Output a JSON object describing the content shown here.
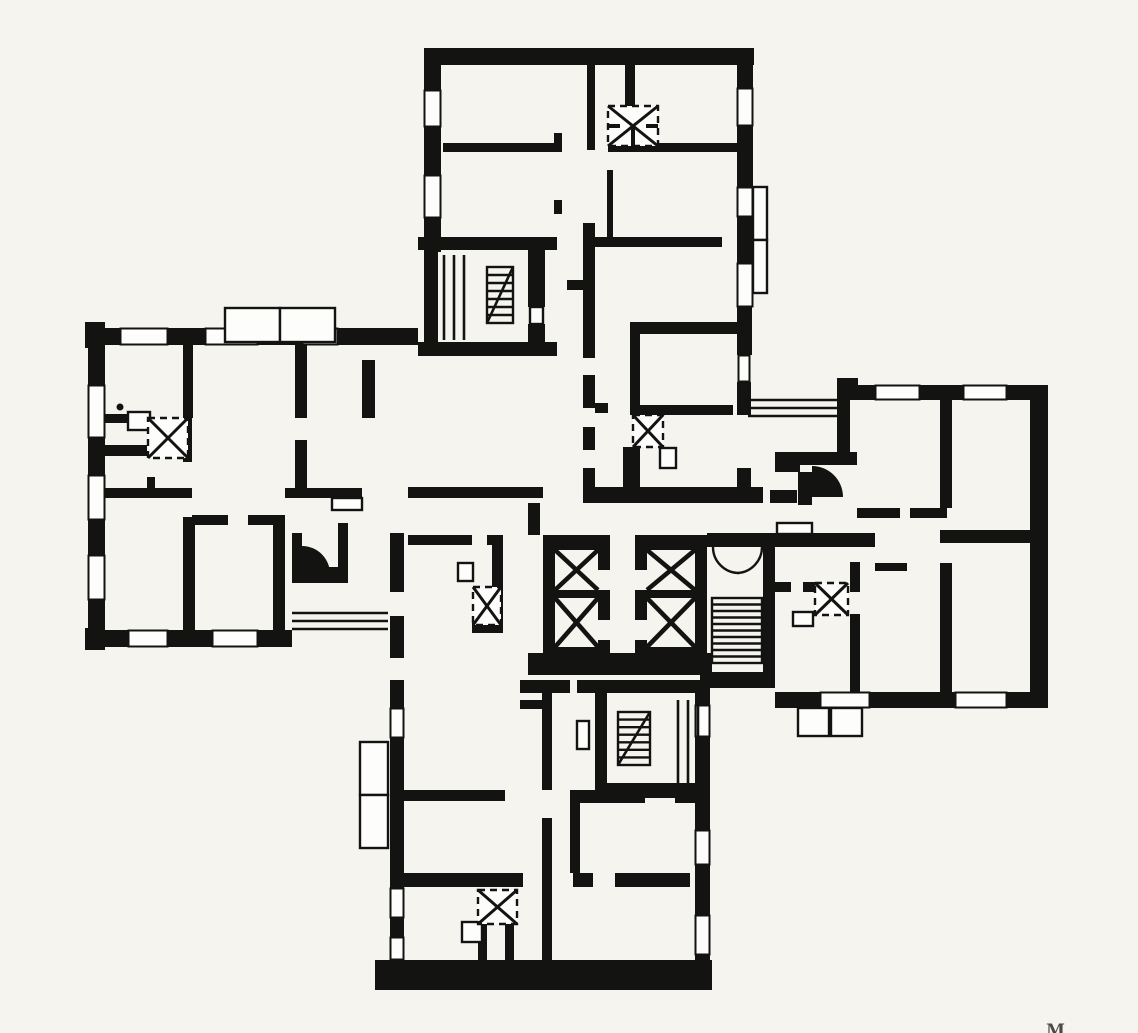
{
  "meta": {
    "kind": "architectural floor plan (scanned, cross-shaped apartment building)",
    "canvas": {
      "w": 1138,
      "h": 1033,
      "paper": "#f5f4ef",
      "ink": "#131312"
    },
    "mark": {
      "text": "M"
    }
  },
  "walls": [
    [
      424,
      48,
      330,
      17
    ],
    [
      424,
      48,
      17,
      42
    ],
    [
      424,
      127,
      17,
      48
    ],
    [
      424,
      218,
      17,
      34
    ],
    [
      737,
      48,
      16,
      40
    ],
    [
      737,
      126,
      16,
      61
    ],
    [
      737,
      217,
      16,
      46
    ],
    [
      737,
      307,
      15,
      48
    ],
    [
      737,
      382,
      14,
      33
    ],
    [
      737,
      468,
      14,
      19
    ],
    [
      443,
      143,
      114,
      9
    ],
    [
      587,
      65,
      8,
      85
    ],
    [
      625,
      65,
      10,
      43
    ],
    [
      608,
      143,
      130,
      9
    ],
    [
      607,
      170,
      6,
      67
    ],
    [
      585,
      237,
      137,
      10
    ],
    [
      583,
      223,
      12,
      135
    ],
    [
      583,
      375,
      12,
      33
    ],
    [
      583,
      427,
      12,
      23
    ],
    [
      583,
      468,
      12,
      19
    ],
    [
      567,
      280,
      18,
      10
    ],
    [
      554,
      133,
      8,
      19
    ],
    [
      554,
      200,
      8,
      14
    ],
    [
      595,
      403,
      13,
      10
    ],
    [
      630,
      322,
      113,
      12
    ],
    [
      630,
      334,
      10,
      74
    ],
    [
      630,
      405,
      103,
      10
    ],
    [
      623,
      447,
      17,
      41
    ],
    [
      583,
      487,
      180,
      16
    ],
    [
      408,
      487,
      135,
      11
    ],
    [
      418,
      237,
      139,
      13
    ],
    [
      424,
      250,
      14,
      92
    ],
    [
      528,
      250,
      17,
      57
    ],
    [
      528,
      324,
      17,
      18
    ],
    [
      418,
      342,
      139,
      14
    ],
    [
      85,
      322,
      20,
      26
    ],
    [
      85,
      628,
      20,
      22
    ],
    [
      88,
      328,
      32,
      17
    ],
    [
      168,
      328,
      37,
      17
    ],
    [
      258,
      328,
      44,
      17
    ],
    [
      338,
      328,
      80,
      17
    ],
    [
      88,
      345,
      17,
      40
    ],
    [
      88,
      438,
      17,
      37
    ],
    [
      88,
      520,
      17,
      35
    ],
    [
      88,
      600,
      17,
      30
    ],
    [
      88,
      630,
      40,
      17
    ],
    [
      168,
      630,
      44,
      17
    ],
    [
      258,
      630,
      34,
      17
    ],
    [
      183,
      345,
      10,
      73
    ],
    [
      183,
      418,
      9,
      44
    ],
    [
      105,
      414,
      23,
      9
    ],
    [
      105,
      445,
      42,
      11
    ],
    [
      147,
      477,
      8,
      15
    ],
    [
      105,
      488,
      87,
      10
    ],
    [
      192,
      515,
      36,
      10
    ],
    [
      248,
      515,
      37,
      10
    ],
    [
      183,
      517,
      12,
      113
    ],
    [
      273,
      517,
      12,
      113
    ],
    [
      295,
      345,
      12,
      73
    ],
    [
      295,
      440,
      12,
      48
    ],
    [
      362,
      360,
      13,
      58
    ],
    [
      285,
      488,
      77,
      10
    ],
    [
      292,
      533,
      10,
      34
    ],
    [
      292,
      567,
      56,
      16
    ],
    [
      338,
      523,
      10,
      44
    ],
    [
      390,
      533,
      14,
      59
    ],
    [
      390,
      616,
      14,
      42
    ],
    [
      390,
      680,
      14,
      28
    ],
    [
      390,
      738,
      14,
      150
    ],
    [
      390,
      918,
      14,
      19
    ],
    [
      408,
      535,
      64,
      10
    ],
    [
      487,
      535,
      16,
      10
    ],
    [
      492,
      545,
      11,
      78
    ],
    [
      472,
      623,
      31,
      10
    ],
    [
      528,
      503,
      12,
      32
    ],
    [
      543,
      535,
      67,
      15
    ],
    [
      543,
      550,
      12,
      97
    ],
    [
      598,
      550,
      12,
      20
    ],
    [
      598,
      590,
      12,
      30
    ],
    [
      598,
      640,
      12,
      7
    ],
    [
      555,
      590,
      43,
      8
    ],
    [
      543,
      647,
      67,
      13
    ],
    [
      635,
      535,
      72,
      15
    ],
    [
      635,
      550,
      12,
      20
    ],
    [
      635,
      590,
      12,
      30
    ],
    [
      635,
      640,
      12,
      7
    ],
    [
      695,
      550,
      12,
      97
    ],
    [
      647,
      590,
      48,
      8
    ],
    [
      635,
      647,
      72,
      13
    ],
    [
      528,
      653,
      184,
      22
    ],
    [
      707,
      533,
      168,
      14
    ],
    [
      763,
      533,
      12,
      155
    ],
    [
      700,
      672,
      75,
      16
    ],
    [
      520,
      680,
      50,
      13
    ],
    [
      520,
      700,
      22,
      9
    ],
    [
      837,
      378,
      21,
      22
    ],
    [
      837,
      400,
      13,
      52
    ],
    [
      850,
      385,
      25,
      15
    ],
    [
      920,
      385,
      43,
      15
    ],
    [
      1007,
      385,
      23,
      15
    ],
    [
      1030,
      385,
      18,
      323
    ],
    [
      775,
      692,
      45,
      16
    ],
    [
      870,
      692,
      85,
      16
    ],
    [
      1007,
      692,
      41,
      16
    ],
    [
      775,
      452,
      25,
      20
    ],
    [
      800,
      452,
      57,
      13
    ],
    [
      798,
      472,
      14,
      33
    ],
    [
      770,
      490,
      27,
      13
    ],
    [
      773,
      582,
      18,
      10
    ],
    [
      803,
      582,
      14,
      10
    ],
    [
      850,
      562,
      10,
      30
    ],
    [
      850,
      614,
      10,
      78
    ],
    [
      875,
      563,
      32,
      8
    ],
    [
      940,
      400,
      12,
      108
    ],
    [
      857,
      508,
      43,
      10
    ],
    [
      910,
      508,
      37,
      10
    ],
    [
      940,
      530,
      90,
      13
    ],
    [
      940,
      563,
      12,
      129
    ],
    [
      402,
      790,
      103,
      11
    ],
    [
      542,
      680,
      10,
      110
    ],
    [
      542,
      818,
      10,
      145
    ],
    [
      402,
      873,
      121,
      14
    ],
    [
      478,
      924,
      9,
      39
    ],
    [
      505,
      924,
      9,
      39
    ],
    [
      570,
      790,
      10,
      83
    ],
    [
      573,
      790,
      72,
      13
    ],
    [
      675,
      790,
      28,
      13
    ],
    [
      573,
      873,
      20,
      14
    ],
    [
      615,
      873,
      75,
      14
    ],
    [
      577,
      680,
      133,
      13
    ],
    [
      595,
      693,
      12,
      90
    ],
    [
      595,
      783,
      115,
      15
    ],
    [
      695,
      693,
      15,
      12
    ],
    [
      695,
      737,
      15,
      93
    ],
    [
      695,
      865,
      15,
      50
    ],
    [
      695,
      955,
      15,
      10
    ],
    [
      375,
      960,
      337,
      30
    ]
  ],
  "windows": [
    [
      424,
      90,
      17,
      37
    ],
    [
      424,
      175,
      17,
      43
    ],
    [
      737,
      88,
      16,
      38
    ],
    [
      737,
      187,
      16,
      30
    ],
    [
      737,
      263,
      16,
      44
    ],
    [
      738,
      355,
      12,
      27
    ],
    [
      120,
      328,
      48,
      17
    ],
    [
      205,
      328,
      53,
      17
    ],
    [
      302,
      328,
      36,
      17
    ],
    [
      88,
      385,
      17,
      53
    ],
    [
      88,
      475,
      17,
      45
    ],
    [
      88,
      555,
      17,
      45
    ],
    [
      128,
      630,
      40,
      17
    ],
    [
      212,
      630,
      46,
      17
    ],
    [
      390,
      708,
      14,
      30
    ],
    [
      390,
      888,
      14,
      30
    ],
    [
      390,
      937,
      14,
      23
    ],
    [
      695,
      705,
      15,
      32
    ],
    [
      695,
      830,
      15,
      35
    ],
    [
      695,
      915,
      15,
      40
    ],
    [
      875,
      385,
      45,
      15
    ],
    [
      963,
      385,
      44,
      15
    ],
    [
      820,
      692,
      50,
      16
    ],
    [
      955,
      692,
      52,
      16
    ]
  ],
  "boxes": [
    [
      225,
      308,
      55,
      34
    ],
    [
      280,
      308,
      55,
      34
    ],
    [
      753,
      187,
      14,
      53
    ],
    [
      753,
      240,
      14,
      53
    ],
    [
      798,
      708,
      31,
      28
    ],
    [
      831,
      708,
      31,
      28
    ],
    [
      360,
      742,
      28,
      53
    ],
    [
      360,
      795,
      28,
      53
    ],
    [
      128,
      412,
      22,
      18
    ],
    [
      458,
      563,
      15,
      18
    ],
    [
      660,
      448,
      16,
      20
    ],
    [
      793,
      612,
      20,
      14
    ],
    [
      462,
      922,
      20,
      20
    ],
    [
      530,
      307,
      13,
      17
    ],
    [
      777,
      523,
      35,
      11
    ],
    [
      332,
      498,
      30,
      12
    ],
    [
      577,
      721,
      12,
      28
    ]
  ],
  "railings": [
    [
      444,
      255,
      444,
      340
    ],
    [
      454,
      255,
      454,
      340
    ],
    [
      464,
      255,
      464,
      340
    ],
    [
      292,
      613,
      388,
      613
    ],
    [
      292,
      621,
      388,
      621
    ],
    [
      292,
      629,
      388,
      629
    ],
    [
      748,
      400,
      840,
      400
    ],
    [
      748,
      408,
      840,
      408
    ],
    [
      748,
      416,
      840,
      416
    ],
    [
      678,
      700,
      678,
      783
    ],
    [
      688,
      700,
      688,
      783
    ],
    [
      698,
      700,
      698,
      783
    ]
  ],
  "stairs": [
    {
      "x": 487,
      "y": 267,
      "w": 26,
      "h": 56,
      "treads": 6,
      "diag": "tr-bl"
    },
    {
      "x": 712,
      "y": 598,
      "w": 50,
      "h": 65,
      "treads": 9,
      "diag": "none"
    },
    {
      "x": 618,
      "y": 712,
      "w": 32,
      "h": 53,
      "treads": 6,
      "diag": "tr-bl"
    }
  ],
  "vent_shafts": [
    {
      "x": 608,
      "y": 106,
      "w": 50,
      "h": 40,
      "star": true
    },
    {
      "x": 148,
      "y": 418,
      "w": 40,
      "h": 40,
      "star": false
    },
    {
      "x": 633,
      "y": 415,
      "w": 30,
      "h": 32,
      "star": false
    },
    {
      "x": 473,
      "y": 587,
      "w": 28,
      "h": 38,
      "star": false
    },
    {
      "x": 815,
      "y": 583,
      "w": 33,
      "h": 32,
      "star": false
    },
    {
      "x": 478,
      "y": 890,
      "w": 39,
      "h": 34,
      "star": false
    }
  ],
  "elevator_cells": [
    [
      555,
      550,
      43,
      40
    ],
    [
      555,
      598,
      43,
      49
    ],
    [
      647,
      550,
      48,
      40
    ],
    [
      647,
      598,
      48,
      49
    ]
  ],
  "door_arcs": [
    "M713,547 A26,26 0 0 0 739,573",
    "M762,547 A26,26 0 0 1 738,573"
  ],
  "door_fans": [
    "M302,546 A28,28 0 0 1 330,574 L302,574 Z",
    "M812,466 A31,31 0 0 1 843,497 L812,497 Z"
  ],
  "dots": [
    [
      120,
      407,
      3.5
    ]
  ]
}
